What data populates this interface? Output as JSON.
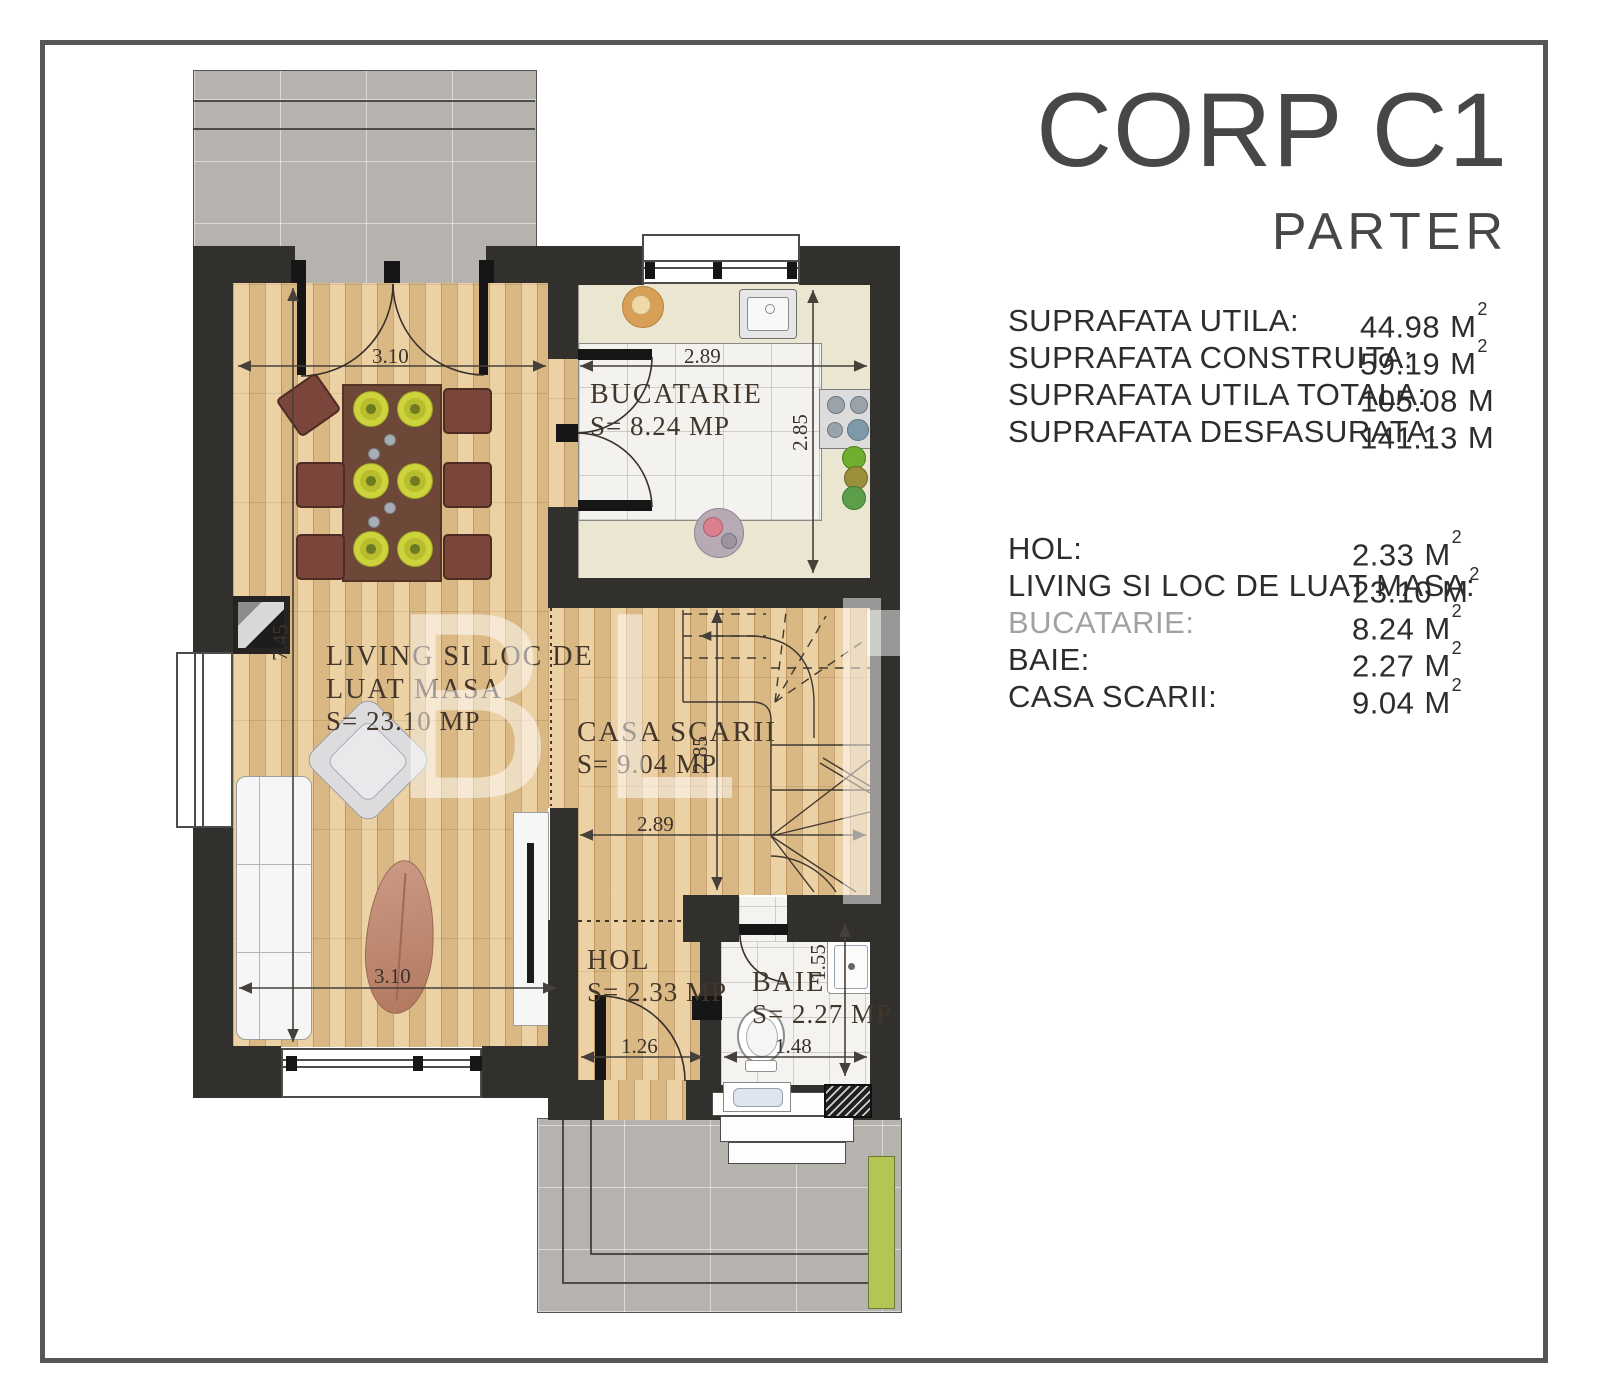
{
  "panel": {
    "title": "CORP C1",
    "subtitle": "PARTER",
    "stats": [
      {
        "label": "SUPRAFATA UTILA:",
        "value": "44.98",
        "unit": "M",
        "sup": "2"
      },
      {
        "label": "SUPRAFATA CONSTRUITA:",
        "value": "59.19",
        "unit": "M",
        "sup": "2"
      },
      {
        "label": "SUPRAFATA UTILA TOTALA:",
        "value": "105.08",
        "unit": "M",
        "sup": ""
      },
      {
        "label": "SUPRAFATA DESFASURATA:",
        "value": "141.13",
        "unit": "M",
        "sup": ""
      }
    ],
    "rooms": [
      {
        "label": "HOL:",
        "value": "2.33",
        "unit": "M",
        "sup": "2"
      },
      {
        "label": "LIVING SI LOC DE LUAT MASA:",
        "value": "23.10",
        "unit": "M",
        "sup": "2"
      },
      {
        "label": "BUCATARIE:",
        "value": "8.24",
        "unit": "M",
        "sup": "2"
      },
      {
        "label": "BAIE:",
        "value": "2.27",
        "unit": "M",
        "sup": "2"
      },
      {
        "label": "CASA SCARII:",
        "value": "9.04",
        "unit": "M",
        "sup": "2"
      }
    ]
  },
  "plan": {
    "watermark": "BL",
    "rooms": {
      "bucatarie": {
        "name": "BUCATARIE",
        "area": "S= 8.24 MP"
      },
      "living": {
        "name_line1": "LIVING SI LOC DE",
        "name_line2": "LUAT MASA",
        "area": "S= 23.10 MP"
      },
      "casa_scarii": {
        "name": "CASA SCARII",
        "area": "S= 9.04 MP"
      },
      "hol": {
        "name": "HOL",
        "area": "S= 2.33 MP"
      },
      "baie": {
        "name": "BAIE",
        "area": "S= 2.27 MP"
      }
    },
    "dimensions": {
      "living_top_width": "3.10",
      "living_bottom_width": "3.10",
      "living_height": "7.45",
      "kitchen_width": "2.89",
      "kitchen_height": "2.85",
      "stair_width": "2.89",
      "stair_height": "2.85",
      "hol_width": "1.26",
      "baie_width": "1.48",
      "baie_height": "1.55"
    }
  }
}
